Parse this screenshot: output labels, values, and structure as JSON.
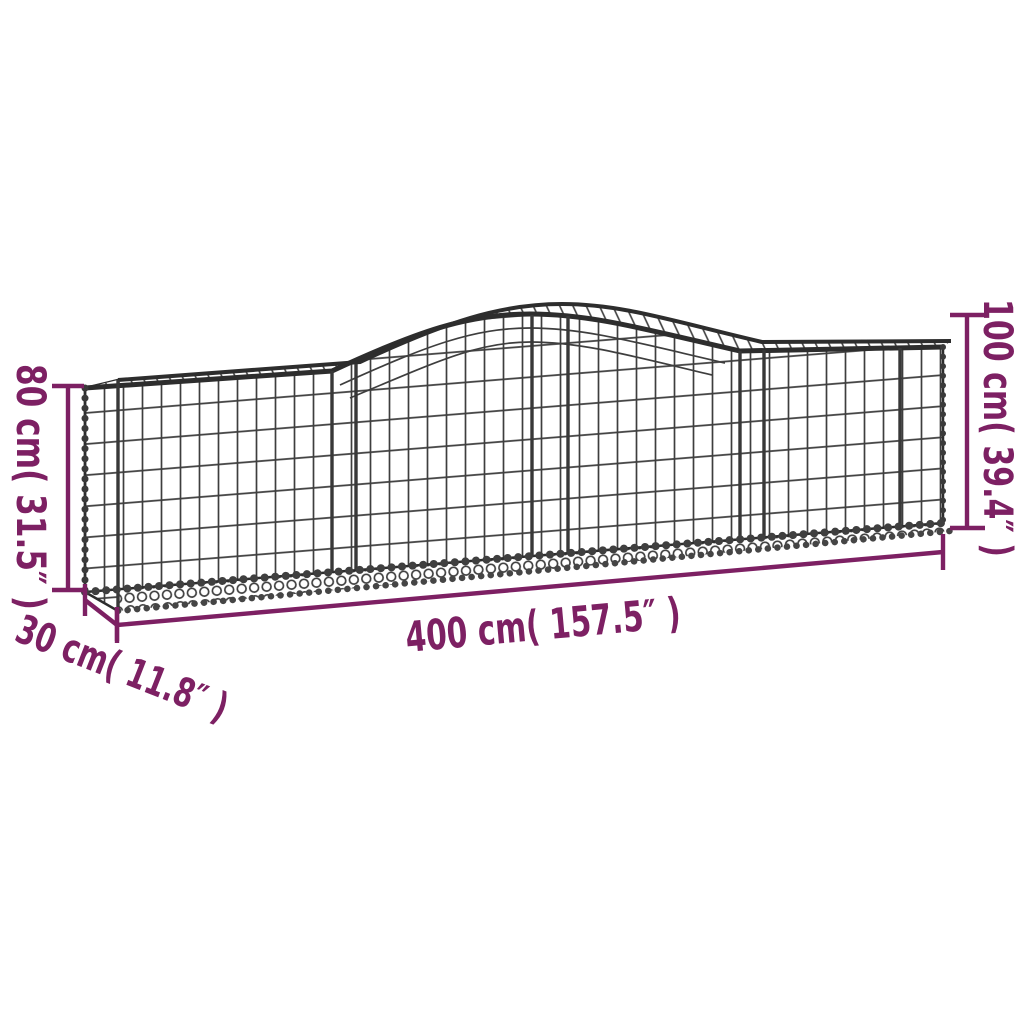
{
  "diagram": {
    "type": "product-dimension-diagram",
    "product": "Arched gabion basket (galvanised iron mesh)",
    "labels": {
      "height_left": "80 cm( 31.5″ )",
      "height_right": "100 cm( 39.4″ )",
      "length": "400 cm( 157.5″ )",
      "depth": "30 cm( 11.8″ )"
    },
    "values": {
      "height_left_cm": 80,
      "height_left_inch": 31.5,
      "height_right_cm": 100,
      "height_right_inch": 39.4,
      "length_cm": 400,
      "length_inch": 157.5,
      "depth_cm": 30,
      "depth_inch": 11.8
    },
    "colors": {
      "dimension_annotation": "#7d2063",
      "mesh_wire": "#3e3e3e",
      "mesh_rim": "#2d2d2d",
      "background": "#ffffff"
    }
  }
}
